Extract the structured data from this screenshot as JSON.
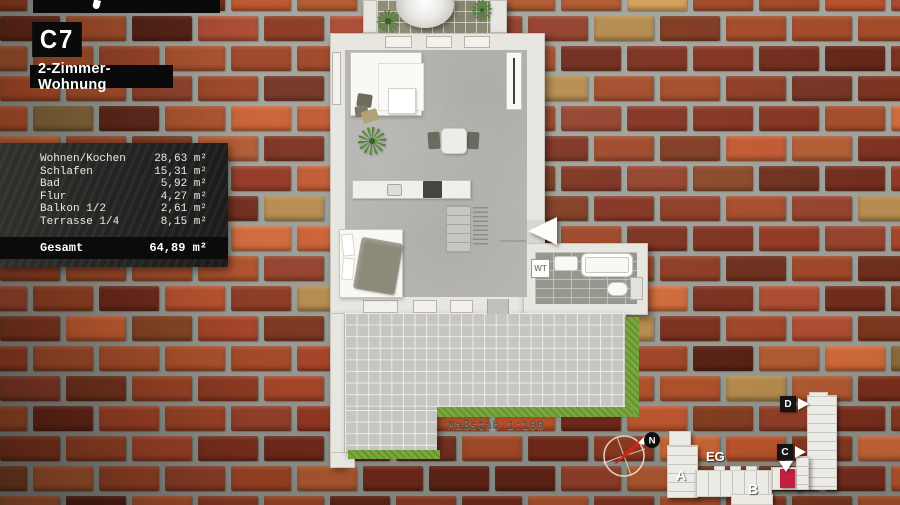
{
  "unit": {
    "code": "C7",
    "type_label": "2-Zimmer-Wohnung"
  },
  "area_table": {
    "rows": [
      {
        "label": "Wohnen/Kochen",
        "value": "28,63 m²"
      },
      {
        "label": "Schlafen",
        "value": "15,31 m²"
      },
      {
        "label": "Bad",
        "value": "5,92 m²"
      },
      {
        "label": "Flur",
        "value": "4,27 m²"
      },
      {
        "label": "Balkon 1/2",
        "value": "2,61 m²"
      },
      {
        "label": "Terrasse 1/4",
        "value": "8,15 m²"
      }
    ],
    "total_label": "Gesamt",
    "total_value": "64,89 m²"
  },
  "floorplan": {
    "scale_label": "Maßstab 1:100",
    "washbasin_label": "WT"
  },
  "compass": {
    "north_label": "N"
  },
  "site_plan": {
    "floor_label": "EG",
    "building_a_label": "A",
    "building_b_label": "B",
    "marker_c_label": "C",
    "marker_d_label": "D"
  },
  "theme": {
    "highlight_red": "#c32040",
    "grass_green": "#79a93c",
    "brick_palette": [
      "#9e4526",
      "#8c3a22",
      "#a34a28",
      "#7c2f1d",
      "#b05a31",
      "#93402a",
      "#702a1a",
      "#ad512b",
      "#b58a4d"
    ]
  }
}
